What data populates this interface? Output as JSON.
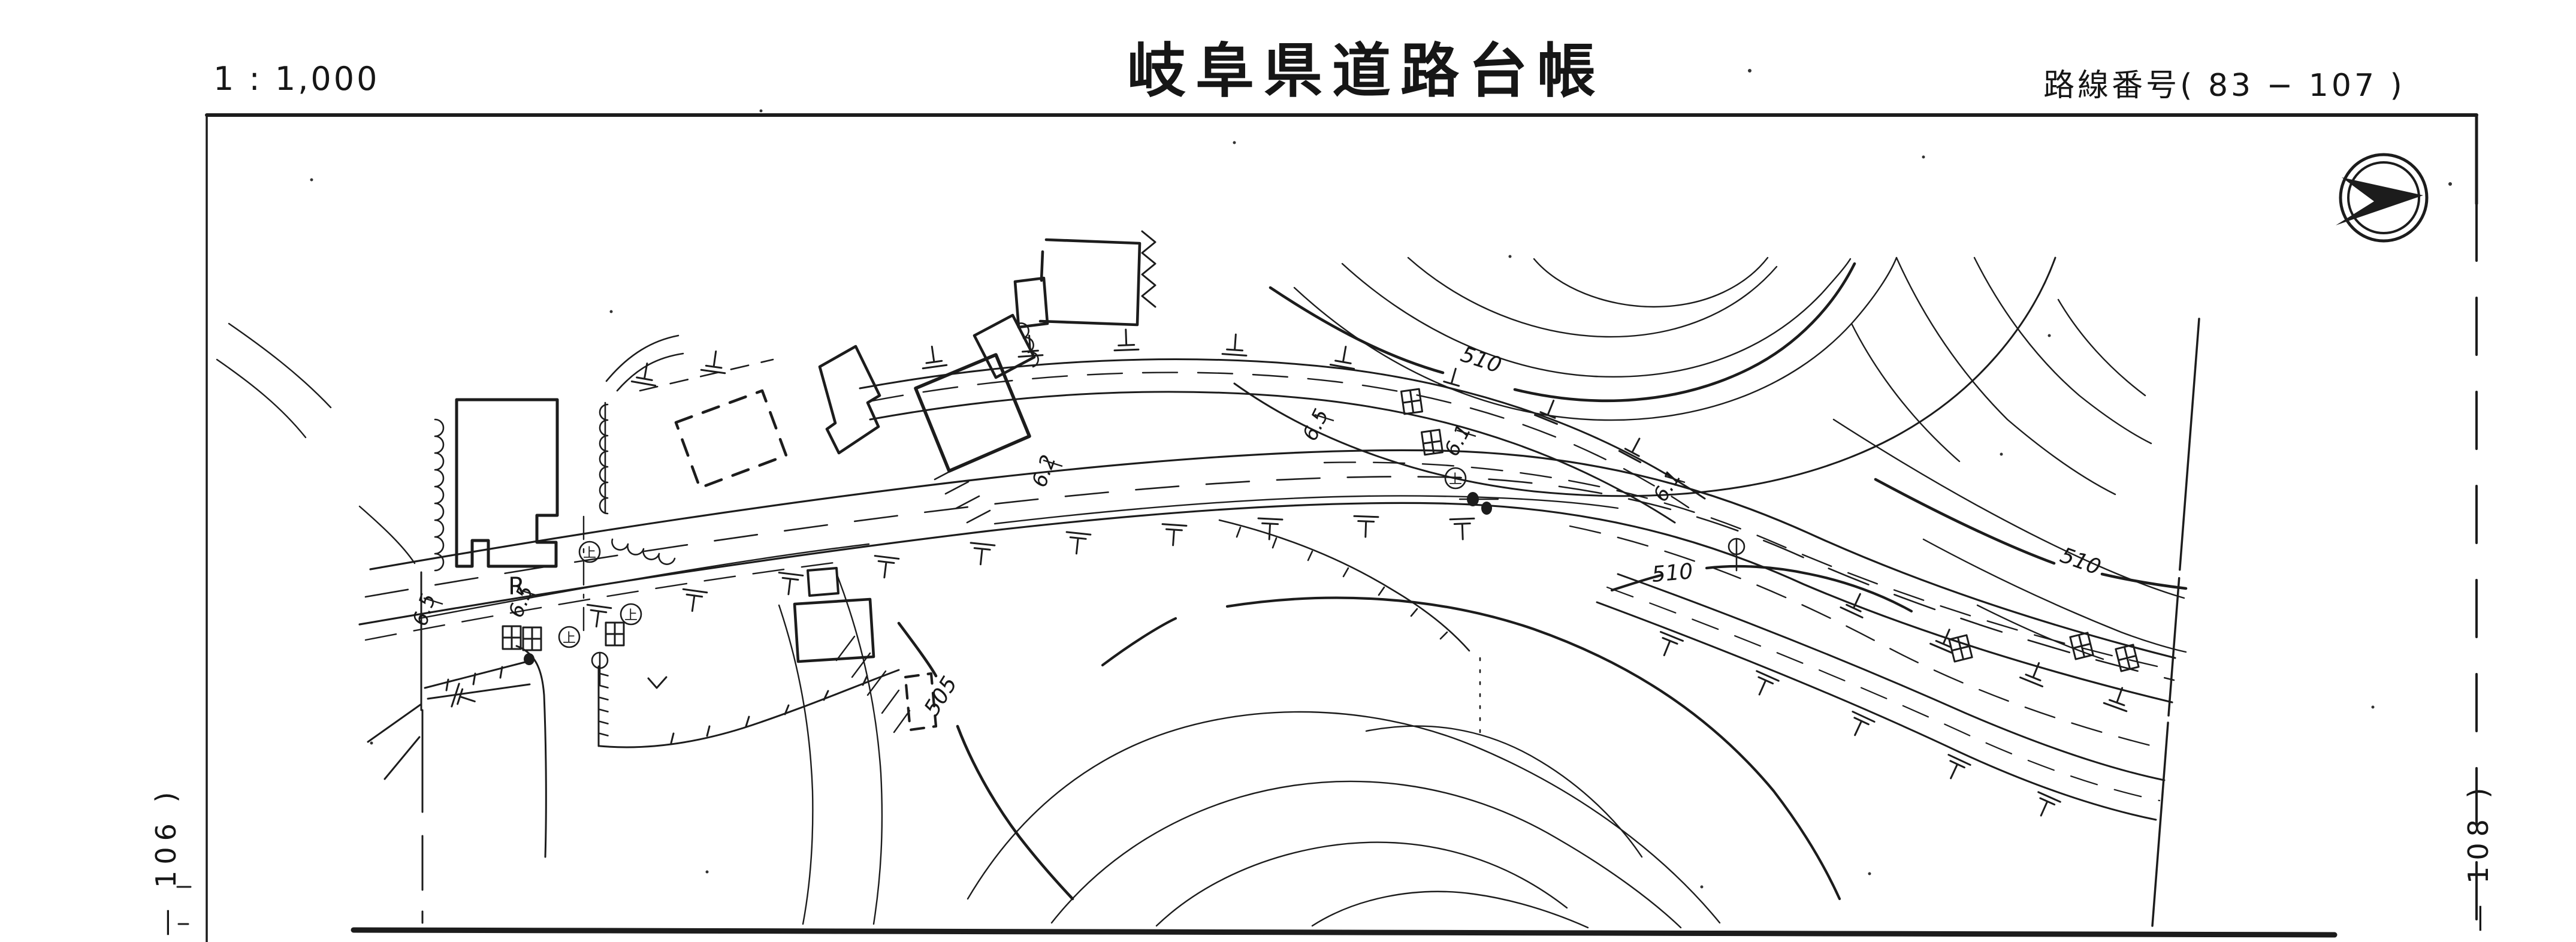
{
  "page": {
    "background": "#ffffff",
    "ink": "#1c1c1c"
  },
  "header": {
    "scale_label": "1 : 1,000",
    "title": "岐阜県道路台帳",
    "route_label": "路線番号(  83 − 107  )"
  },
  "sheet": {
    "left_adjacent": "— 106 )",
    "right_adjacent": "— 108 )"
  },
  "icons": {
    "north_arrow": "north-arrow"
  },
  "map": {
    "contour_labels": [
      {
        "text": "510"
      },
      {
        "text": "510"
      },
      {
        "text": "510"
      },
      {
        "text": "505"
      }
    ],
    "width_labels": [
      {
        "text": "6.5"
      },
      {
        "text": "6.5"
      },
      {
        "text": "6.2"
      },
      {
        "text": "6.5"
      },
      {
        "text": "6.1"
      },
      {
        "text": "6.1"
      }
    ],
    "curve_label": "R",
    "pole_glyph": "上"
  }
}
